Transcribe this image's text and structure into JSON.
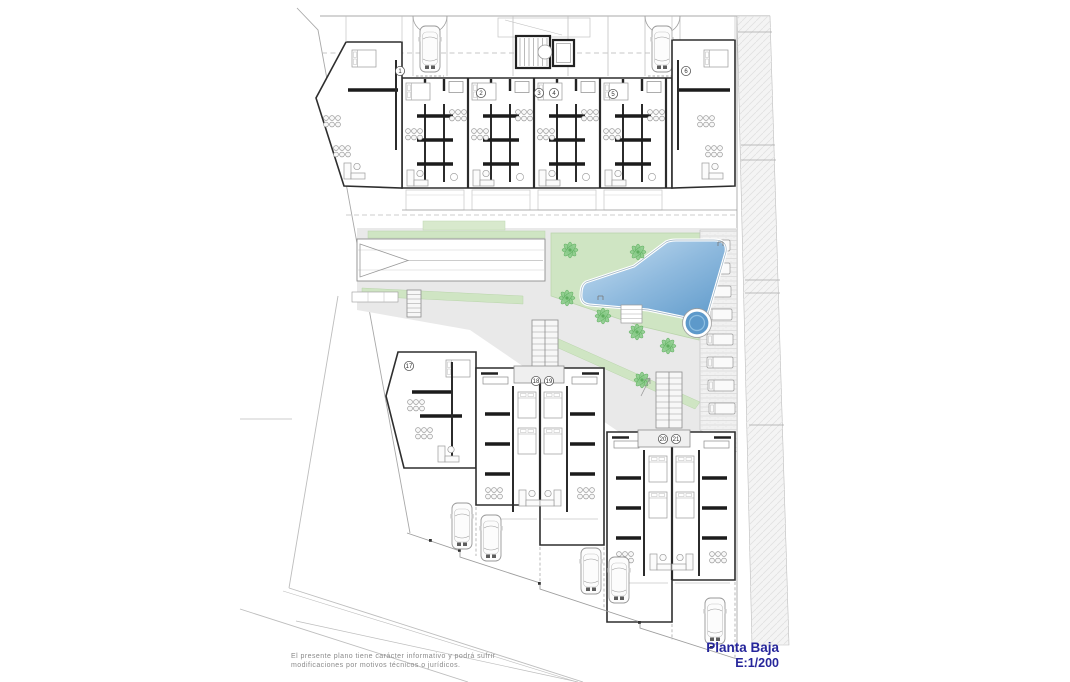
{
  "document": {
    "title": "Planta Baja",
    "scale": "E:1/200",
    "disclaimer_line1": "El presente plano tiene carácter informativo y podrá sufrir",
    "disclaimer_line2": "modificaciones por motivos técnicos o jurídicos."
  },
  "units": {
    "top_row": [
      "1",
      "2",
      "3",
      "4",
      "5",
      "6"
    ],
    "lower_left": [
      "17",
      "18",
      "19"
    ],
    "lower_right": [
      "20",
      "21"
    ]
  },
  "features": {
    "pool": "swimming-pool",
    "jacuzzi": "circular-spa",
    "garden": "landscaped-garden",
    "ramp": "garage-ramp",
    "stairs": "exterior-stairs",
    "loungers": "sun-lounger-deck",
    "parking": "parking-spaces",
    "trees": "palm-tree"
  },
  "colors": {
    "title_blue": "#26269b",
    "pool_light": "#c3dcf0",
    "pool_deep": "#639dcc",
    "garden_green": "#cfe5c3",
    "tree_green": "#84c884",
    "paving_grey": "#e9e9e9",
    "wall_black": "#2b2b2b"
  }
}
